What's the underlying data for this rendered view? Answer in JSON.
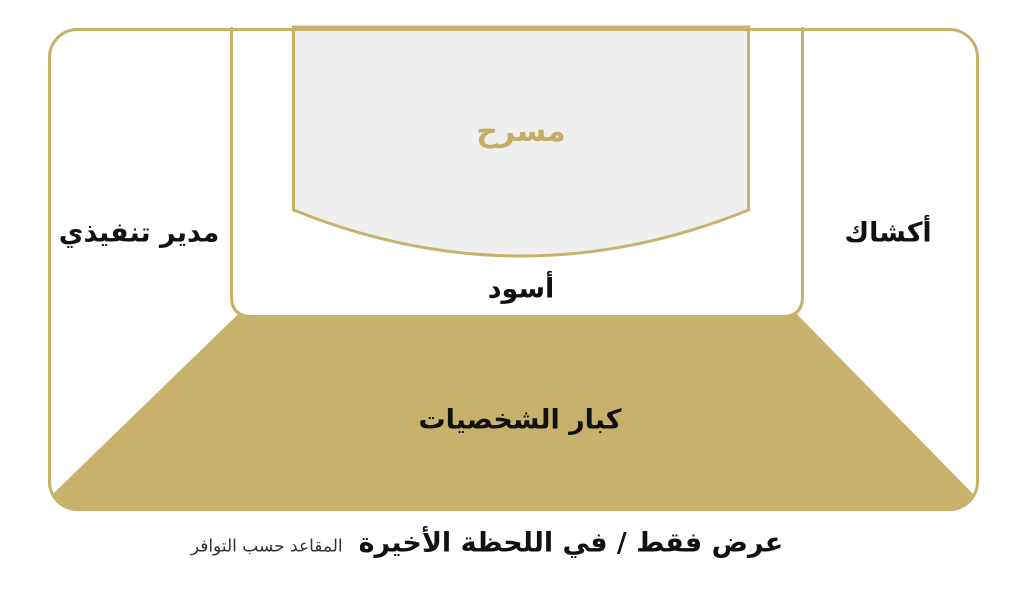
{
  "diagram": {
    "title_hint": "venue-seating-map",
    "labels": {
      "stage": "مسرح",
      "black": "أسود",
      "executive": "مدير تنفيذي",
      "kiosks": "أكشاك",
      "vip": "كبار الشخصيات"
    },
    "caption": {
      "main": "عرض فقط / في اللحظة الأخيرة",
      "note": "المقاعد حسب التوافر"
    },
    "colors": {
      "gold": "#C8B26B",
      "gold_text": "#C4AD66",
      "stage_fill": "#EFEFEF",
      "text": "#111111",
      "note_text": "#333333",
      "background": "#FFFFFF"
    }
  }
}
